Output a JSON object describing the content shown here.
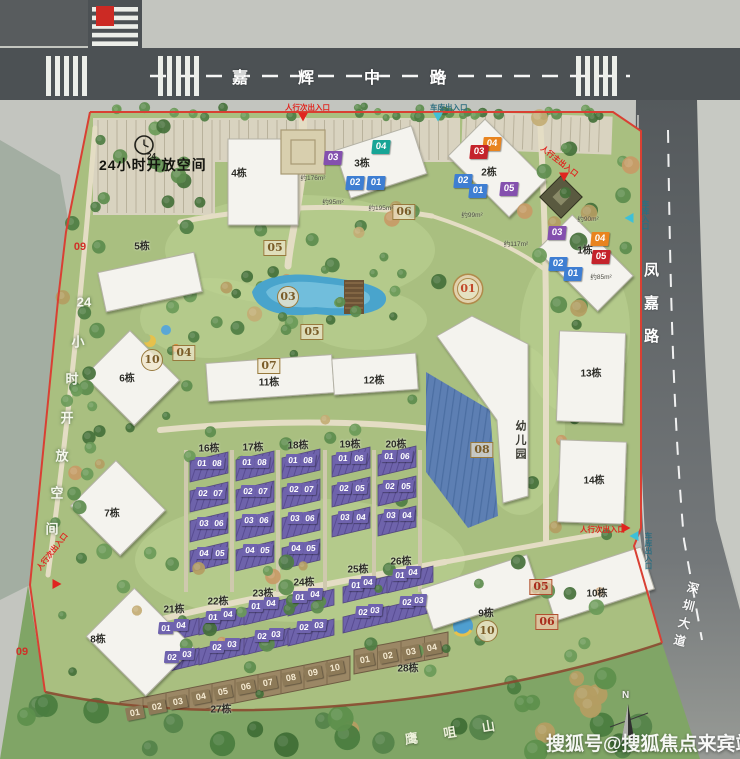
{
  "roads": {
    "top": "嘉辉中路",
    "right": "凤嘉路",
    "bottom_right": "深圳大道"
  },
  "landmarks": {
    "mountain": "鹰咀山",
    "kindergarten": "幼儿园"
  },
  "watermark": "搜狐号@搜狐焦点来宾站",
  "compass": "N",
  "open_space": {
    "horizontal": "24小时开放空间",
    "vertical": "24小时开放空间",
    "clock_label": "24"
  },
  "boundary_numbers": [
    {
      "t": "09",
      "x": 80,
      "y": 247
    },
    {
      "t": "09",
      "x": 22,
      "y": 652
    }
  ],
  "entrances": [
    {
      "text": "人行次出入口",
      "color": "red",
      "x": 285,
      "y": 102,
      "rot": 0,
      "vertical": false,
      "marker": {
        "x": 303,
        "y": 117,
        "dir": "down"
      }
    },
    {
      "text": "车库出入口",
      "color": "teal",
      "x": 430,
      "y": 102,
      "rot": 0,
      "vertical": false,
      "marker": {
        "x": 438,
        "y": 117,
        "dir": "down"
      }
    },
    {
      "text": "车库入口",
      "color": "teal",
      "x": 640,
      "y": 200,
      "rot": 0,
      "vertical": true,
      "marker": {
        "x": 629,
        "y": 218,
        "dir": "left"
      }
    },
    {
      "text": "人行主出入口",
      "color": "red",
      "x": 545,
      "y": 143,
      "rot": 38,
      "vertical": false,
      "marker": {
        "x": 564,
        "y": 177,
        "dir": "down"
      }
    },
    {
      "text": "人行次出入口",
      "color": "red",
      "x": 580,
      "y": 524,
      "rot": 0,
      "vertical": false,
      "marker": {
        "x": 626,
        "y": 528,
        "dir": "right"
      }
    },
    {
      "text": "车库出入口",
      "color": "teal",
      "x": 643,
      "y": 532,
      "rot": 0,
      "vertical": true,
      "marker": {
        "x": 634,
        "y": 536,
        "dir": "left"
      }
    },
    {
      "text": "人行次出入口",
      "color": "red",
      "x": 34,
      "y": 566,
      "rot": -52,
      "vertical": false,
      "marker": {
        "x": 57,
        "y": 584,
        "dir": "right"
      }
    }
  ],
  "building_labels": [
    {
      "t": "1栋",
      "x": 585,
      "y": 249
    },
    {
      "t": "2栋",
      "x": 489,
      "y": 171
    },
    {
      "t": "3栋",
      "x": 362,
      "y": 162
    },
    {
      "t": "4栋",
      "x": 239,
      "y": 172
    },
    {
      "t": "5栋",
      "x": 142,
      "y": 245
    },
    {
      "t": "6栋",
      "x": 127,
      "y": 377
    },
    {
      "t": "7栋",
      "x": 112,
      "y": 512
    },
    {
      "t": "8栋",
      "x": 98,
      "y": 638
    },
    {
      "t": "9栋",
      "x": 486,
      "y": 612
    },
    {
      "t": "10栋",
      "x": 597,
      "y": 592
    },
    {
      "t": "11栋",
      "x": 269,
      "y": 381
    },
    {
      "t": "12栋",
      "x": 374,
      "y": 379
    },
    {
      "t": "13栋",
      "x": 591,
      "y": 372
    },
    {
      "t": "14栋",
      "x": 594,
      "y": 479
    },
    {
      "t": "16栋",
      "x": 209,
      "y": 447
    },
    {
      "t": "17栋",
      "x": 253,
      "y": 446
    },
    {
      "t": "18栋",
      "x": 298,
      "y": 444
    },
    {
      "t": "19栋",
      "x": 350,
      "y": 443
    },
    {
      "t": "20栋",
      "x": 396,
      "y": 443
    },
    {
      "t": "21栋",
      "x": 174,
      "y": 608
    },
    {
      "t": "22栋",
      "x": 218,
      "y": 600
    },
    {
      "t": "23栋",
      "x": 263,
      "y": 592
    },
    {
      "t": "24栋",
      "x": 304,
      "y": 581
    },
    {
      "t": "25栋",
      "x": 358,
      "y": 568
    },
    {
      "t": "26栋",
      "x": 401,
      "y": 560
    },
    {
      "t": "27栋",
      "x": 221,
      "y": 708
    },
    {
      "t": "28栋",
      "x": 408,
      "y": 667
    }
  ],
  "unit_markers": [
    {
      "t": "03",
      "c": "purple",
      "x": 333,
      "y": 158
    },
    {
      "t": "04",
      "c": "teal",
      "x": 381,
      "y": 147
    },
    {
      "t": "02",
      "c": "blue",
      "x": 355,
      "y": 183
    },
    {
      "t": "01",
      "c": "blue",
      "x": 376,
      "y": 183
    },
    {
      "t": "04",
      "c": "orange",
      "x": 492,
      "y": 144
    },
    {
      "t": "03",
      "c": "red",
      "x": 479,
      "y": 152
    },
    {
      "t": "02",
      "c": "blue",
      "x": 463,
      "y": 181
    },
    {
      "t": "01",
      "c": "blue",
      "x": 478,
      "y": 191
    },
    {
      "t": "05",
      "c": "purple",
      "x": 509,
      "y": 189
    },
    {
      "t": "03",
      "c": "purple",
      "x": 557,
      "y": 233
    },
    {
      "t": "04",
      "c": "orange",
      "x": 600,
      "y": 239
    },
    {
      "t": "05",
      "c": "red",
      "x": 601,
      "y": 257
    },
    {
      "t": "02",
      "c": "blue",
      "x": 558,
      "y": 264
    },
    {
      "t": "01",
      "c": "blue",
      "x": 573,
      "y": 274
    },
    {
      "t": "01",
      "c": "tp",
      "x": 202,
      "y": 463
    },
    {
      "t": "08",
      "c": "tp",
      "x": 217,
      "y": 463
    },
    {
      "t": "02",
      "c": "tp",
      "x": 203,
      "y": 493
    },
    {
      "t": "07",
      "c": "tp",
      "x": 218,
      "y": 493
    },
    {
      "t": "03",
      "c": "tp",
      "x": 204,
      "y": 523
    },
    {
      "t": "06",
      "c": "tp",
      "x": 219,
      "y": 523
    },
    {
      "t": "04",
      "c": "tp",
      "x": 204,
      "y": 553
    },
    {
      "t": "05",
      "c": "tp",
      "x": 220,
      "y": 553
    },
    {
      "t": "01",
      "c": "tp",
      "x": 247,
      "y": 462
    },
    {
      "t": "08",
      "c": "tp",
      "x": 262,
      "y": 462
    },
    {
      "t": "02",
      "c": "tp",
      "x": 248,
      "y": 491
    },
    {
      "t": "07",
      "c": "tp",
      "x": 263,
      "y": 491
    },
    {
      "t": "03",
      "c": "tp",
      "x": 249,
      "y": 520
    },
    {
      "t": "06",
      "c": "tp",
      "x": 264,
      "y": 520
    },
    {
      "t": "04",
      "c": "tp",
      "x": 250,
      "y": 550
    },
    {
      "t": "05",
      "c": "tp",
      "x": 265,
      "y": 550
    },
    {
      "t": "01",
      "c": "tp",
      "x": 293,
      "y": 460
    },
    {
      "t": "08",
      "c": "tp",
      "x": 308,
      "y": 460
    },
    {
      "t": "02",
      "c": "tp",
      "x": 294,
      "y": 489
    },
    {
      "t": "07",
      "c": "tp",
      "x": 309,
      "y": 489
    },
    {
      "t": "03",
      "c": "tp",
      "x": 295,
      "y": 518
    },
    {
      "t": "06",
      "c": "tp",
      "x": 310,
      "y": 518
    },
    {
      "t": "04",
      "c": "tp",
      "x": 296,
      "y": 548
    },
    {
      "t": "05",
      "c": "tp",
      "x": 311,
      "y": 548
    },
    {
      "t": "01",
      "c": "tp",
      "x": 343,
      "y": 458
    },
    {
      "t": "06",
      "c": "tp",
      "x": 359,
      "y": 458
    },
    {
      "t": "02",
      "c": "tp",
      "x": 344,
      "y": 488
    },
    {
      "t": "05",
      "c": "tp",
      "x": 360,
      "y": 488
    },
    {
      "t": "03",
      "c": "tp",
      "x": 345,
      "y": 517
    },
    {
      "t": "04",
      "c": "tp",
      "x": 361,
      "y": 517
    },
    {
      "t": "01",
      "c": "tp",
      "x": 389,
      "y": 456
    },
    {
      "t": "06",
      "c": "tp",
      "x": 405,
      "y": 456
    },
    {
      "t": "02",
      "c": "tp",
      "x": 390,
      "y": 486
    },
    {
      "t": "05",
      "c": "tp",
      "x": 406,
      "y": 486
    },
    {
      "t": "03",
      "c": "tp",
      "x": 391,
      "y": 515
    },
    {
      "t": "04",
      "c": "tp",
      "x": 407,
      "y": 515
    },
    {
      "t": "01",
      "c": "tp",
      "x": 166,
      "y": 628
    },
    {
      "t": "04",
      "c": "tp",
      "x": 181,
      "y": 625
    },
    {
      "t": "02",
      "c": "tp",
      "x": 172,
      "y": 657
    },
    {
      "t": "03",
      "c": "tp",
      "x": 187,
      "y": 654
    },
    {
      "t": "01",
      "c": "tp",
      "x": 213,
      "y": 617
    },
    {
      "t": "04",
      "c": "tp",
      "x": 228,
      "y": 614
    },
    {
      "t": "02",
      "c": "tp",
      "x": 217,
      "y": 647
    },
    {
      "t": "03",
      "c": "tp",
      "x": 232,
      "y": 644
    },
    {
      "t": "01",
      "c": "tp",
      "x": 256,
      "y": 606
    },
    {
      "t": "04",
      "c": "tp",
      "x": 271,
      "y": 603
    },
    {
      "t": "02",
      "c": "tp",
      "x": 262,
      "y": 636
    },
    {
      "t": "03",
      "c": "tp",
      "x": 276,
      "y": 634
    },
    {
      "t": "01",
      "c": "tp",
      "x": 300,
      "y": 597
    },
    {
      "t": "04",
      "c": "tp",
      "x": 315,
      "y": 594
    },
    {
      "t": "02",
      "c": "tp",
      "x": 304,
      "y": 627
    },
    {
      "t": "03",
      "c": "tp",
      "x": 319,
      "y": 625
    },
    {
      "t": "01",
      "c": "tp",
      "x": 356,
      "y": 585
    },
    {
      "t": "04",
      "c": "tp",
      "x": 368,
      "y": 582
    },
    {
      "t": "02",
      "c": "tp",
      "x": 363,
      "y": 612
    },
    {
      "t": "03",
      "c": "tp",
      "x": 375,
      "y": 610
    },
    {
      "t": "01",
      "c": "tp",
      "x": 400,
      "y": 575
    },
    {
      "t": "04",
      "c": "tp",
      "x": 413,
      "y": 572
    },
    {
      "t": "02",
      "c": "tp",
      "x": 407,
      "y": 602
    },
    {
      "t": "03",
      "c": "tp",
      "x": 419,
      "y": 600
    },
    {
      "t": "01",
      "c": "br",
      "x": 135,
      "y": 713
    },
    {
      "t": "02",
      "c": "br",
      "x": 157,
      "y": 707
    },
    {
      "t": "03",
      "c": "br",
      "x": 178,
      "y": 702
    },
    {
      "t": "04",
      "c": "br",
      "x": 201,
      "y": 697
    },
    {
      "t": "05",
      "c": "br",
      "x": 223,
      "y": 692
    },
    {
      "t": "06",
      "c": "br",
      "x": 246,
      "y": 687
    },
    {
      "t": "07",
      "c": "br",
      "x": 268,
      "y": 683
    },
    {
      "t": "08",
      "c": "br",
      "x": 291,
      "y": 678
    },
    {
      "t": "09",
      "c": "br",
      "x": 313,
      "y": 673
    },
    {
      "t": "10",
      "c": "br",
      "x": 335,
      "y": 668
    },
    {
      "t": "01",
      "c": "br",
      "x": 365,
      "y": 660
    },
    {
      "t": "02",
      "c": "br",
      "x": 388,
      "y": 656
    },
    {
      "t": "03",
      "c": "br",
      "x": 411,
      "y": 652
    },
    {
      "t": "04",
      "c": "br",
      "x": 432,
      "y": 648
    }
  ],
  "amenity_markers": [
    {
      "t": "05",
      "k": "sq",
      "x": 275,
      "y": 248
    },
    {
      "t": "06",
      "k": "sq",
      "x": 404,
      "y": 212
    },
    {
      "t": "03",
      "k": "circ",
      "x": 288,
      "y": 297
    },
    {
      "t": "05",
      "k": "sq",
      "x": 312,
      "y": 332
    },
    {
      "t": "04",
      "k": "sq",
      "x": 184,
      "y": 353
    },
    {
      "t": "10",
      "k": "circ",
      "x": 152,
      "y": 360
    },
    {
      "t": "07",
      "k": "sq",
      "x": 269,
      "y": 366
    },
    {
      "t": "08",
      "k": "sq",
      "x": 482,
      "y": 450
    },
    {
      "t": "01",
      "k": "ring",
      "x": 468,
      "y": 289
    },
    {
      "t": "10",
      "k": "circ",
      "x": 487,
      "y": 631
    },
    {
      "t": "05",
      "k": "redsq",
      "x": 541,
      "y": 587
    },
    {
      "t": "06",
      "k": "redsq",
      "x": 547,
      "y": 622
    }
  ],
  "area_labels": [
    {
      "t": "约176m²",
      "x": 313,
      "y": 177
    },
    {
      "t": "约95m²",
      "x": 333,
      "y": 201
    },
    {
      "t": "约195m²",
      "x": 381,
      "y": 207
    },
    {
      "t": "约99m²",
      "x": 472,
      "y": 214
    },
    {
      "t": "约90m²",
      "x": 588,
      "y": 218
    },
    {
      "t": "约117m²",
      "x": 516,
      "y": 243
    },
    {
      "t": "约85m²",
      "x": 601,
      "y": 276
    }
  ],
  "colors": {
    "blue": "#3e7ed2",
    "teal": "#17a596",
    "purple": "#8450ae",
    "red": "#c4232b",
    "orange": "#e8841f",
    "townhouse_purple": "#6f63ae",
    "brown": "#8d7a58",
    "gold": "#7a5c28",
    "boundary_red": "#d94033",
    "road": "#4c5154",
    "grass": "#a9bf80",
    "water": "#a3aea2",
    "hill": "#80a566"
  }
}
